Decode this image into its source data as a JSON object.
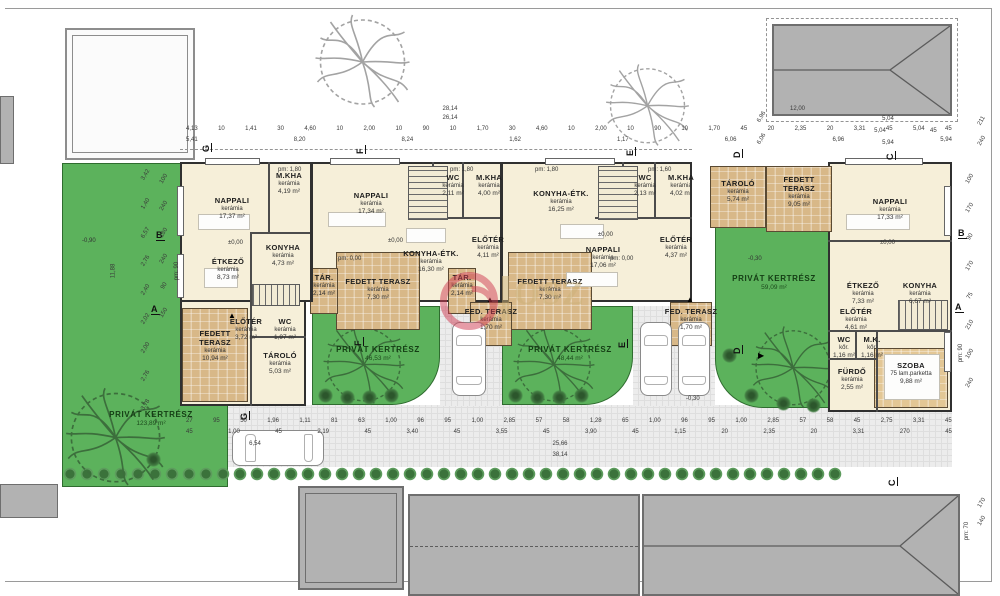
{
  "watermark": {
    "text": "OSZ"
  },
  "gardens": [
    {
      "label": "PRIVÁT KERTRÉSZ",
      "area": "123,89 m²"
    },
    {
      "label": "PRIVÁT KERTRÉSZ",
      "area": "46,53 m²"
    },
    {
      "label": "PRIVÁT KERTRÉSZ",
      "area": "48,44 m²"
    },
    {
      "label": "PRIVÁT KERTRÉSZ",
      "area": "59,09 m²"
    }
  ],
  "units": [
    {
      "rooms": [
        {
          "name": "NAPPALI",
          "material": "kerámia",
          "area": "17,37 m²"
        },
        {
          "name": "M.KHA",
          "material": "kerámia",
          "area": "4,19 m²"
        },
        {
          "name": "KONYHA",
          "material": "kerámia",
          "area": "4,73 m²"
        },
        {
          "name": "ÉTKEZŐ",
          "material": "kerámia",
          "area": "8,73 m²"
        },
        {
          "name": "ELŐTÉR",
          "material": "kerámia",
          "area": "3,72 m²"
        },
        {
          "name": "WC",
          "material": "kerámia",
          "area": "1,97 m²"
        },
        {
          "name": "TÁROLÓ",
          "material": "kerámia",
          "area": "5,03 m²"
        },
        {
          "name": "FEDETT TERASZ",
          "material": "kerámia",
          "area": "10,94 m²"
        }
      ]
    },
    {
      "rooms": [
        {
          "name": "NAPPALI",
          "material": "kerámia",
          "area": "17,34 m²"
        },
        {
          "name": "WC",
          "material": "kerámia",
          "area": "2,11 m²"
        },
        {
          "name": "M.KHA",
          "material": "kerámia",
          "area": "4,00 m²"
        },
        {
          "name": "KONYHA-ÉTK.",
          "material": "kerámia",
          "area": "16,30 m²"
        },
        {
          "name": "ELŐTÉR",
          "material": "kerámia",
          "area": "4,11 m²"
        },
        {
          "name": "TÁR.",
          "material": "kerámia",
          "area": "2,14 m²"
        },
        {
          "name": "FEDETT TERASZ",
          "material": "kerámia",
          "area": "7,30 m²"
        },
        {
          "name": "FED. TERASZ",
          "material": "kerámia",
          "area": "1,70 m²"
        }
      ]
    },
    {
      "rooms": [
        {
          "name": "KONYHA-ÉTK.",
          "material": "kerámia",
          "area": "16,25 m²"
        },
        {
          "name": "WC",
          "material": "kerámia",
          "area": "2,13 m²"
        },
        {
          "name": "M.KHA",
          "material": "kerámia",
          "area": "4,02 m²"
        },
        {
          "name": "NAPPALI",
          "material": "kerámia",
          "area": "17,06 m²"
        },
        {
          "name": "ELŐTÉR",
          "material": "kerámia",
          "area": "4,37 m²"
        },
        {
          "name": "TÁR.",
          "material": "kerámia",
          "area": "2,14 m²"
        },
        {
          "name": "FEDETT TERASZ",
          "material": "kerámia",
          "area": "7,30 m²"
        },
        {
          "name": "FED. TERASZ",
          "material": "kerámia",
          "area": "1,70 m²"
        }
      ]
    },
    {
      "rooms": [
        {
          "name": "TÁROLÓ",
          "material": "kerámia",
          "area": "5,74 m²"
        },
        {
          "name": "FEDETT TERASZ",
          "material": "kerámia",
          "area": "9,05 m²"
        },
        {
          "name": "NAPPALI",
          "material": "kerámia",
          "area": "17,33 m²"
        },
        {
          "name": "ÉTKEZŐ",
          "material": "kerámia",
          "area": "7,33 m²"
        },
        {
          "name": "KONYHA",
          "material": "kerámia",
          "area": "6,67 m²"
        },
        {
          "name": "ELŐTÉR",
          "material": "kerámia",
          "area": "4,61 m²"
        },
        {
          "name": "WC",
          "material": "kőr.",
          "area": "1,16 m²"
        },
        {
          "name": "M.K.",
          "material": "kőr.",
          "area": "1,16 m²"
        },
        {
          "name": "FÜRDŐ",
          "material": "kerámia",
          "area": "2,55 m²"
        },
        {
          "name": "SZOBA",
          "material": "75 lam.parketta",
          "area": "9,88 m²"
        }
      ]
    }
  ],
  "levels": {
    "zero": "±0,00",
    "pm180": "pm: 1,80",
    "pm160": "pm: 1,60",
    "pm000": "pm: 0,00",
    "pm90": "pm: 90",
    "m030": "-0,30",
    "m090": "-0,90",
    "pm70": "pm: 70"
  },
  "markers": {
    "a": "A",
    "b": "B",
    "c": "C",
    "d": "D",
    "e": "E",
    "f": "F",
    "g": "G"
  },
  "dimensions": {
    "total_top_1": "28,14",
    "total_top_2": "26,14",
    "top_chain": [
      "4,13",
      "10",
      "1,41",
      "30",
      "4,60",
      "10",
      "2,00",
      "10",
      "90",
      "10",
      "1,70",
      "30",
      "4,60",
      "10",
      "2,00",
      "10",
      "90",
      "10",
      "1,70",
      "45",
      "20",
      "2,35",
      "20",
      "3,31",
      "45",
      "5,04",
      "45"
    ],
    "top_chain2": [
      "5,41",
      "8,20",
      "8,24",
      "1,62",
      "1,17",
      "6,06",
      "6,96",
      "5,94"
    ],
    "bottom_chain": [
      "27",
      "95",
      "50",
      "1,96",
      "1,11",
      "81",
      "63",
      "1,00",
      "96",
      "95",
      "1,00",
      "2,85",
      "57",
      "58",
      "1,28",
      "65",
      "1,00",
      "96",
      "95",
      "1,00",
      "2,85",
      "57",
      "58",
      "45",
      "2,75",
      "3,31",
      "45"
    ],
    "bottom_chain2": [
      "45",
      "1,00",
      "45",
      "2,19",
      "45",
      "3,40",
      "45",
      "3,55",
      "45",
      "3,90",
      "45",
      "1,15",
      "20",
      "2,35",
      "20",
      "3,31",
      "270",
      "45"
    ],
    "bottom_total_1": "6,54",
    "bottom_total_2": "25,66",
    "bottom_total_3": "38,14",
    "right_block": "12,00",
    "right_upper_1": "5,04",
    "right_upper_2": "5,04",
    "right_upper_2b": "45",
    "right_upper_3": "5,94",
    "right_mid": [
      "6,96",
      "6,06"
    ],
    "right_side": [
      "211",
      "240"
    ],
    "right_lower": [
      "170",
      "140"
    ],
    "left_chain": [
      "3,42",
      "1,40",
      "6,57",
      "2,76",
      "2,40",
      "2,02",
      "2,00",
      "2,76",
      "3,78"
    ],
    "left_total": "11,88",
    "left_windows": [
      "100",
      "240",
      "180",
      "240",
      "90",
      "150"
    ],
    "right_windows": [
      "100",
      "170",
      "90",
      "170",
      "75",
      "210",
      "100",
      "240"
    ]
  }
}
